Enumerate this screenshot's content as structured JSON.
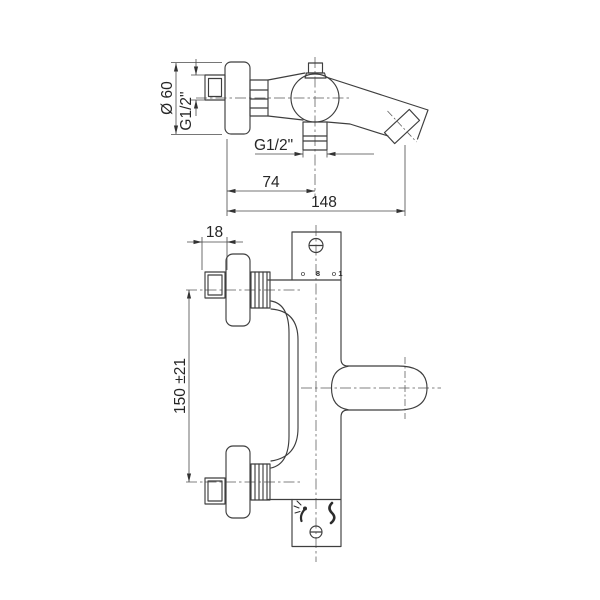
{
  "page": {
    "background": "#ffffff",
    "line_color": "#3e3e3e",
    "text_color": "#262626",
    "subject": "wall-mounted bath shower mixer tap - dimensioned two-view technical drawing"
  },
  "side_view": {
    "labels": {
      "rosette_diameter": "Ø 60",
      "wall_thread": "G1/2\"",
      "outlet_thread": "G1/2\"",
      "wall_to_outlet_axis": "74",
      "wall_to_spout_tip": "148"
    }
  },
  "front_view": {
    "labels": {
      "union_width": "18",
      "inlet_spacing": "150 ±21"
    },
    "scale_marks": [
      "o",
      "8",
      "o",
      "1"
    ],
    "icons": [
      "screw-icon",
      "shower-spray-icon",
      "bath-flow-icon",
      "screw-icon"
    ]
  }
}
